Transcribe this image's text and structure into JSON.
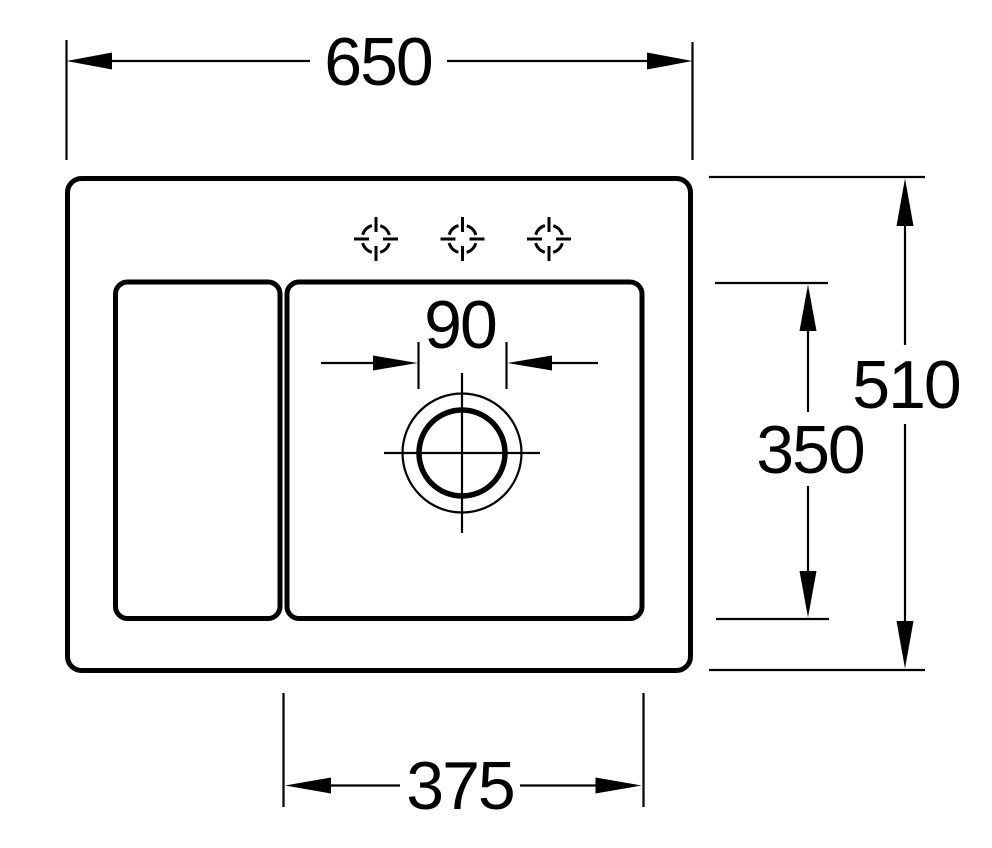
{
  "figure": {
    "kind": "sink-installation-dimension-drawing",
    "colors": {
      "line": "#000000",
      "background": "#ffffff"
    }
  },
  "dims": {
    "overall_width": "650",
    "overall_height": "510",
    "basin_height": "350",
    "drain_hole": "90",
    "basin_width": "375"
  }
}
